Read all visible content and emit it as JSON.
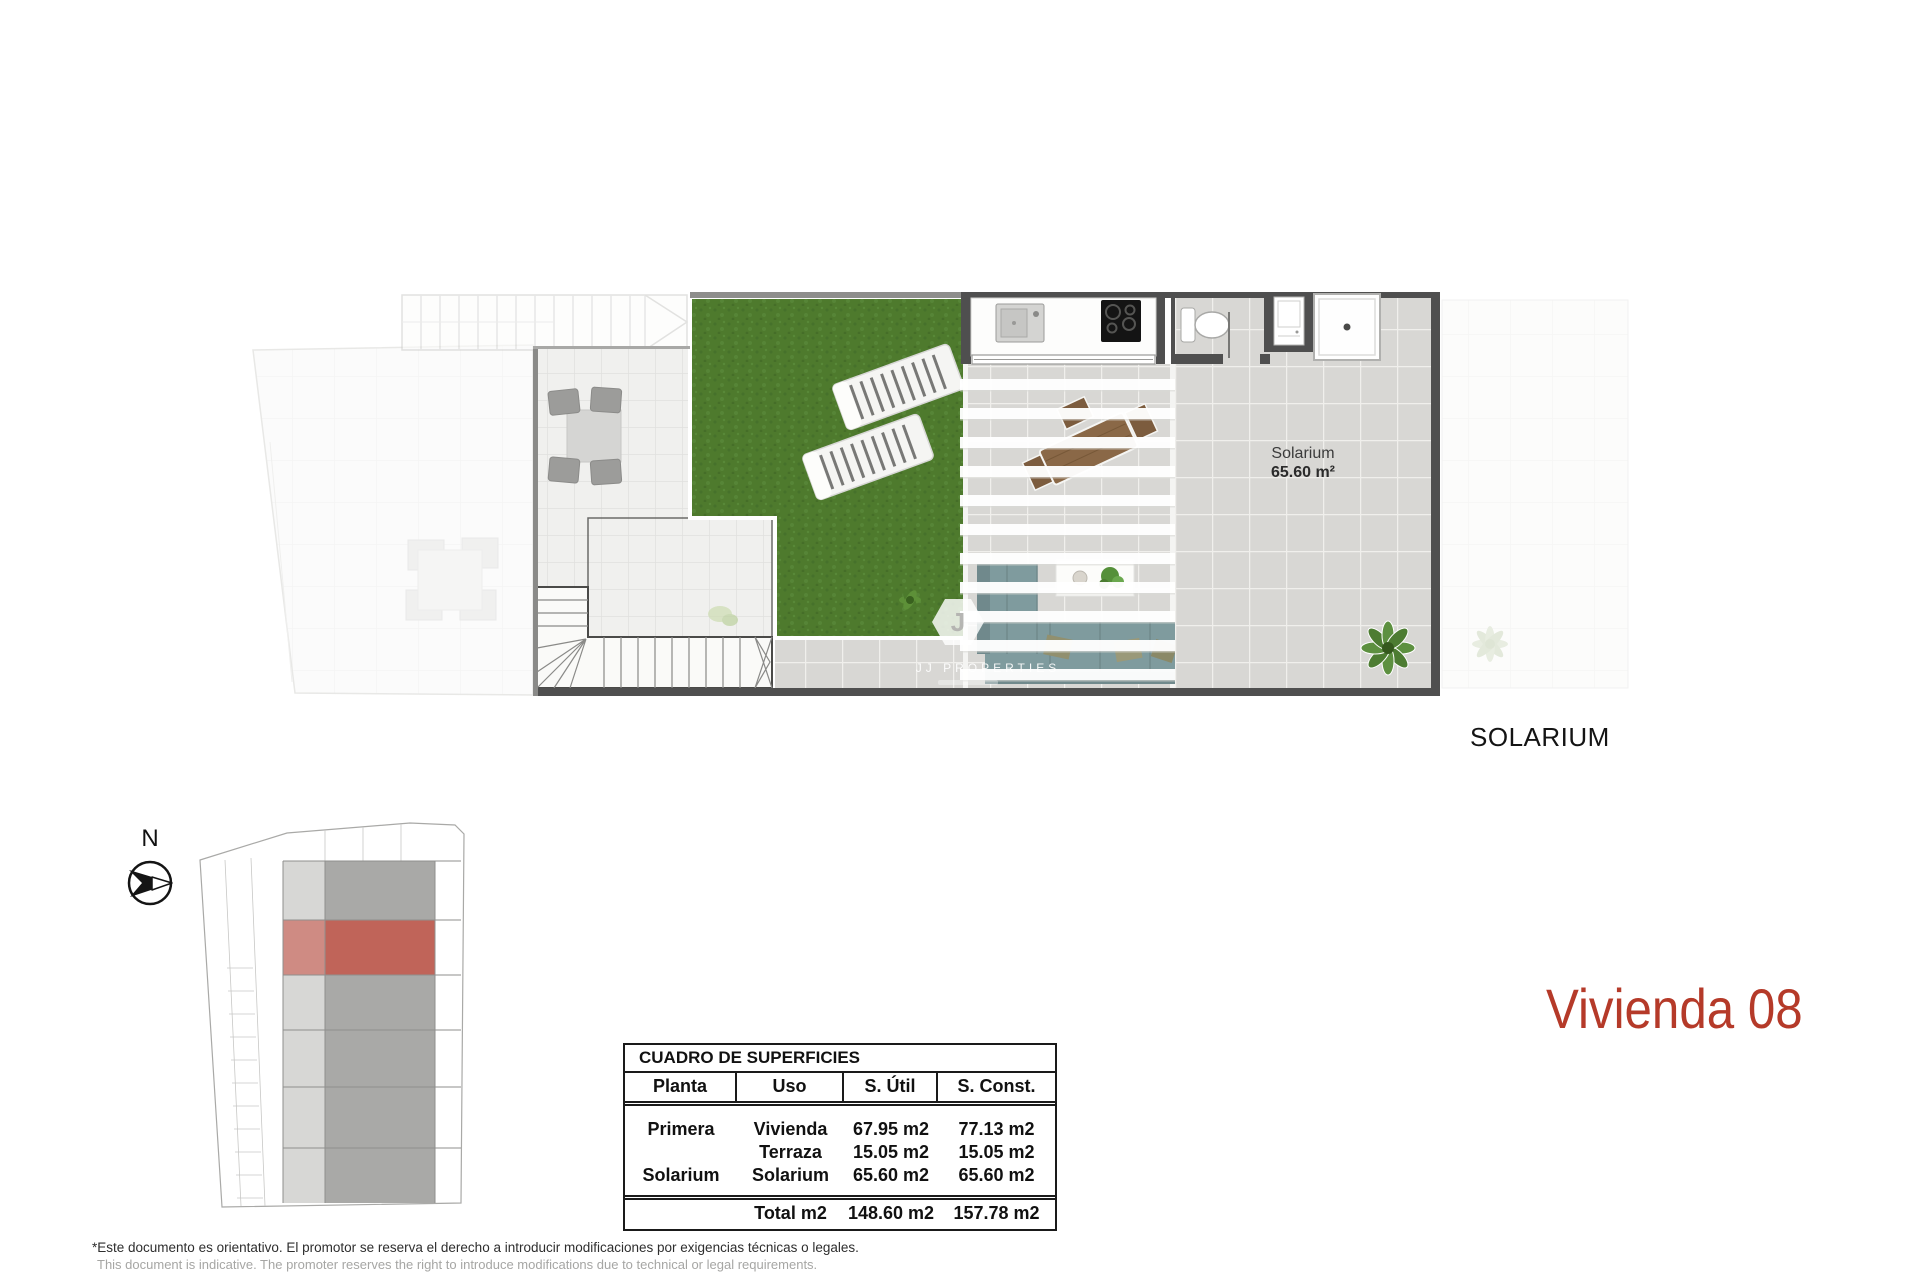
{
  "title": {
    "text": "Vivienda 08"
  },
  "compass": {
    "north_label": "N"
  },
  "plan": {
    "solarium_label": "Solarium",
    "solarium_area": "65.60 m²",
    "floor_label": "SOLARIUM",
    "watermark": "JJ PROPERTIES",
    "logo_letter": "J"
  },
  "table": {
    "title": "CUADRO DE SUPERFICIES",
    "headers": [
      "Planta",
      "Uso",
      "S. Útil",
      "S. Const."
    ],
    "rows": [
      [
        "Primera",
        "Vivienda",
        "67.95 m2",
        "77.13 m2"
      ],
      [
        "",
        "Terraza",
        "15.05 m2",
        "15.05 m2"
      ],
      [
        "Solarium",
        "Solarium",
        "65.60 m2",
        "65.60 m2"
      ]
    ],
    "total_row": [
      "",
      "Total m2",
      "148.60 m2",
      "157.78 m2"
    ]
  },
  "footer": {
    "line1": "*Este documento es orientativo. El promotor se reserva el derecho a introducir modificaciones por exigencias técnicas o legales.",
    "line2": "This document is indicative. The promoter reserves the right to introduce modifications due to technical or legal requirements."
  },
  "colors": {
    "accent_red": "#b53a29",
    "site_highlight": "#c06459",
    "grass_green": "#4e7a2d",
    "tile_gray": "#d8d7d4",
    "wall_gray": "#4f4f4f"
  }
}
